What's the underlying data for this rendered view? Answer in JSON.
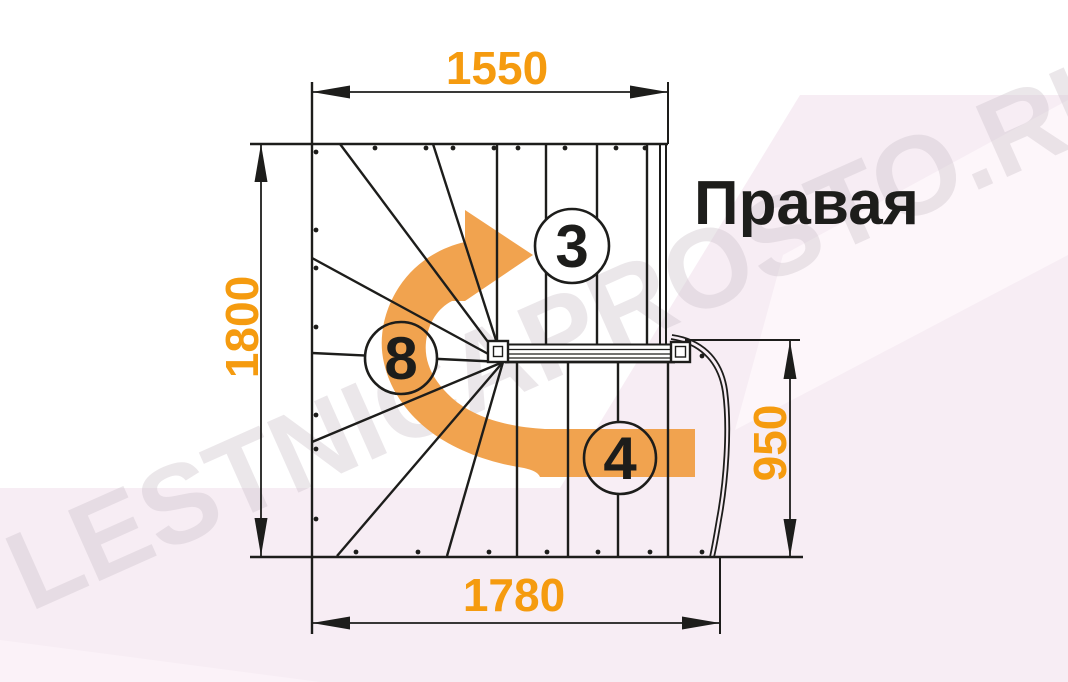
{
  "title": {
    "text": "Правая"
  },
  "watermark": {
    "text": "LESTNICAPROSTO.RU"
  },
  "dimensions": {
    "top": "1550",
    "left": "1800",
    "right": "950",
    "bottom": "1780"
  },
  "labels": {
    "flight_upper": "3",
    "winder": "8",
    "flight_lower": "4"
  },
  "colors": {
    "dimension_orange": "#f59b0f",
    "arrow_orange": "#f1a34f",
    "line_black": "#1d1d1b",
    "background_pink": "#f7edf4",
    "background_pink_light": "#fdf6fa",
    "watermark_gray": "#cfc5cd"
  }
}
